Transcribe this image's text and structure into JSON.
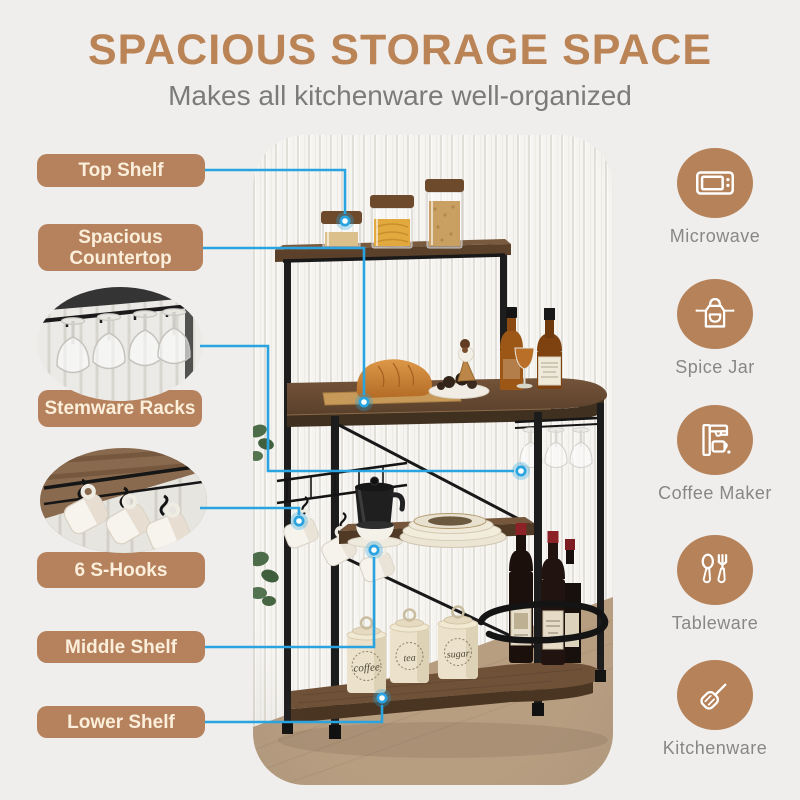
{
  "header": {
    "title": "SPACIOUS STORAGE SPACE",
    "subtitle": "Makes all kitchenware well-organized"
  },
  "callouts": [
    {
      "label": "Top Shelf"
    },
    {
      "label": "Spacious Countertop"
    },
    {
      "label": "Stemware Racks"
    },
    {
      "label": "6 S-Hooks"
    },
    {
      "label": "Middle Shelf"
    },
    {
      "label": "Lower Shelf"
    }
  ],
  "features": [
    {
      "label": "Microwave",
      "icon": "microwave-icon"
    },
    {
      "label": "Spice Jar",
      "icon": "apron-icon"
    },
    {
      "label": "Coffee Maker",
      "icon": "coffee-maker-icon"
    },
    {
      "label": "Tableware",
      "icon": "cutlery-icon"
    },
    {
      "label": "Kitchenware",
      "icon": "spatula-icon"
    }
  ],
  "photo": {
    "canisters": [
      {
        "label": "coffee"
      },
      {
        "label": "tea"
      },
      {
        "label": "sugar"
      }
    ]
  },
  "colors": {
    "accent_brown": "#b5825d",
    "title_brown": "#bb8456",
    "accent_blue": "#29a4e0",
    "text_gray": "#7b7b7b",
    "pill_text": "#fbeeda"
  }
}
